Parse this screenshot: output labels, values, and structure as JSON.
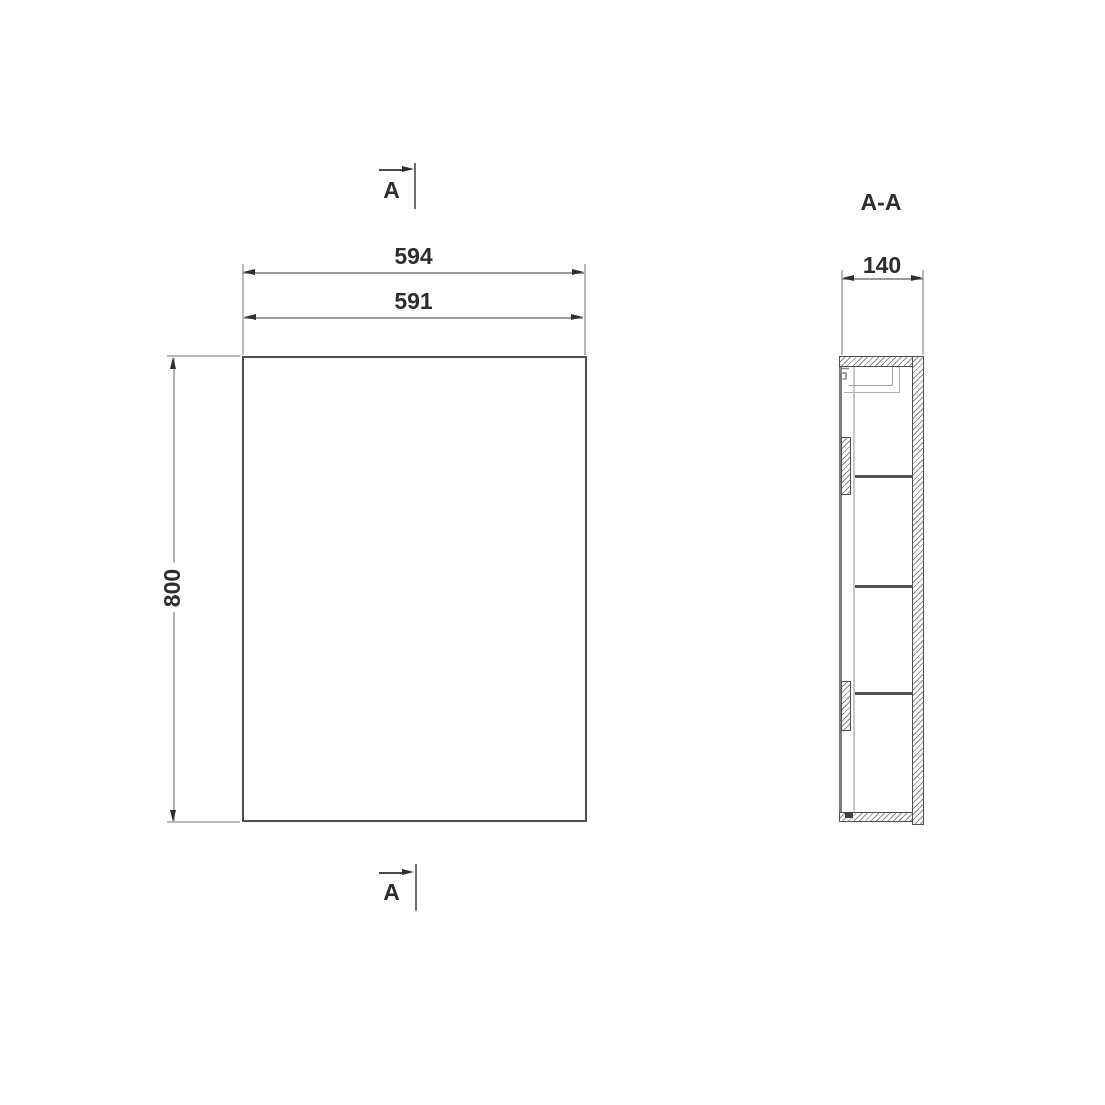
{
  "front_view": {
    "dim_width_outer": "594",
    "dim_width_inner": "591",
    "dim_height": "800",
    "section_cut_label_top": "A",
    "section_cut_label_bottom": "A"
  },
  "section_view": {
    "title": "A-A",
    "dim_depth": "140"
  },
  "colors": {
    "background": "#ffffff",
    "outline": "#4f4f4f",
    "dimension_line": "#9a9a9a",
    "arrowhead": "#2f2f2f",
    "text": "#2d2d2d",
    "hatch": "#8a8a8a",
    "mirror_door": "#7d7d7d"
  }
}
